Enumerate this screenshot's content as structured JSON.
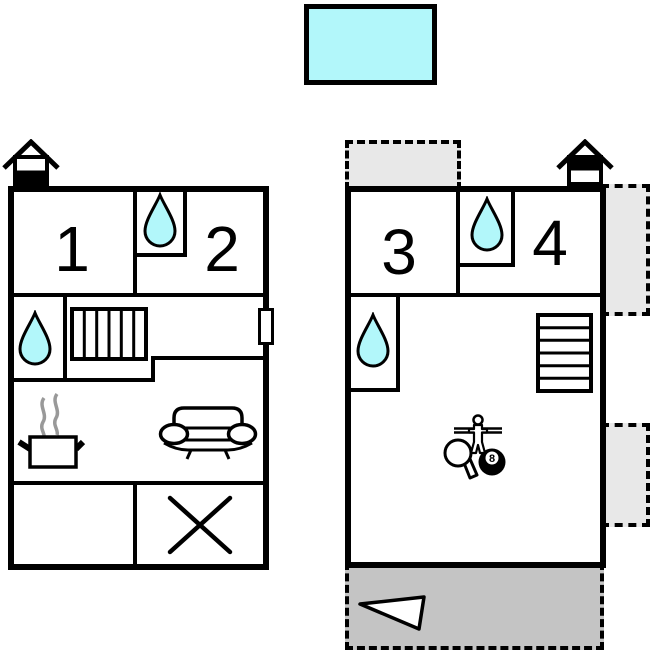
{
  "canvas": {
    "width": 654,
    "height": 652
  },
  "colors": {
    "wall": "#000000",
    "water_fill": "#b2f7fa",
    "pool_fill": "#b2f7fa",
    "terrace_light": "#e8e8e8",
    "terrace_dark": "#c4c4c4",
    "steam": "#999999",
    "background": "#ffffff"
  },
  "pool": {
    "label": "swimming-pool"
  },
  "floorplans": [
    {
      "id": "ground-floor",
      "level_marker": "house-icon-lower-half-filled",
      "rooms": [
        {
          "number": "1"
        },
        {
          "number": "2"
        }
      ],
      "icons": [
        "water-drop",
        "water-drop",
        "staircase-vertical",
        "entrance-door",
        "steaming-pot",
        "sofa",
        "crossed-room"
      ]
    },
    {
      "id": "upper-floor",
      "level_marker": "house-icon-upper-half-filled",
      "rooms": [
        {
          "number": "3"
        },
        {
          "number": "4"
        }
      ],
      "icons": [
        "water-drop",
        "water-drop",
        "staircase-horizontal",
        "foosball-player",
        "table-tennis-paddle",
        "billiard-8-ball",
        "terrace-triangle"
      ],
      "billiard_ball_label": "8"
    }
  ],
  "terraces": [
    {
      "id": "upper-left-balcony"
    },
    {
      "id": "upper-right-balcony-top"
    },
    {
      "id": "upper-right-balcony-bottom"
    },
    {
      "id": "bottom-terrace"
    }
  ]
}
